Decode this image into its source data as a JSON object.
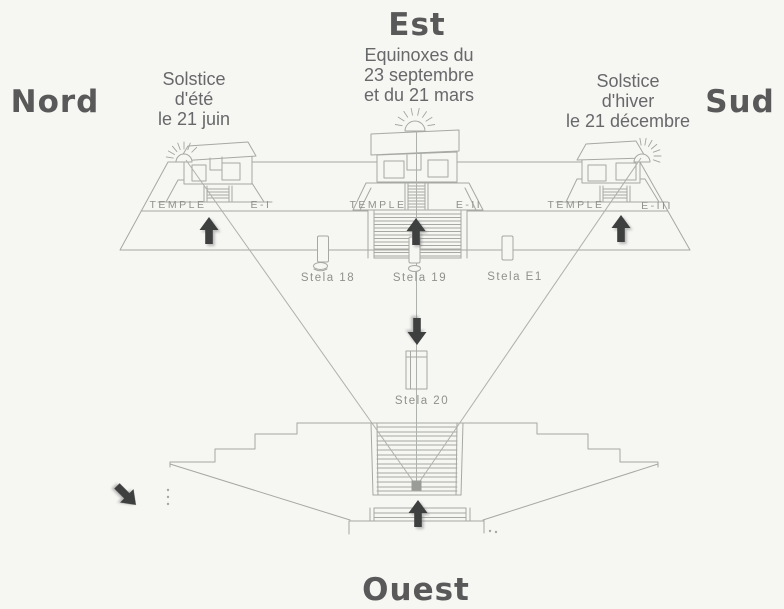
{
  "compass": {
    "north": "Nord",
    "east": "Est",
    "south": "Sud",
    "west": "Ouest"
  },
  "captions": {
    "east": [
      "Equinoxes du",
      "23 septembre",
      "et du 21 mars"
    ],
    "north": [
      "Solstice",
      "d'été",
      "le 21 juin"
    ],
    "south": [
      "Solstice",
      "d'hiver",
      "le 21 décembre"
    ]
  },
  "temples": [
    {
      "label": "TEMPLE",
      "code": "E-I"
    },
    {
      "label": "TEMPLE",
      "code": "E-II"
    },
    {
      "label": "TEMPLE",
      "code": "E-III"
    }
  ],
  "stelae": {
    "s18": "Stela 18",
    "s19": "Stela 19",
    "se1": "Stela E1",
    "s20": "Stela 20"
  },
  "icons": {
    "sun_north": "sunrise-icon",
    "sun_east": "sunrise-icon",
    "sun_south": "sunrise-icon",
    "arrows": "direction-arrow"
  },
  "colors": {
    "background": "#f6f6f3",
    "heading_text": "#59595a",
    "caption_text": "#67686a",
    "drawing_line": "#a6a8a3",
    "diagram_label": "#8f918d",
    "arrow": "#3e3f3f",
    "marker_square": "#9a9c98"
  }
}
